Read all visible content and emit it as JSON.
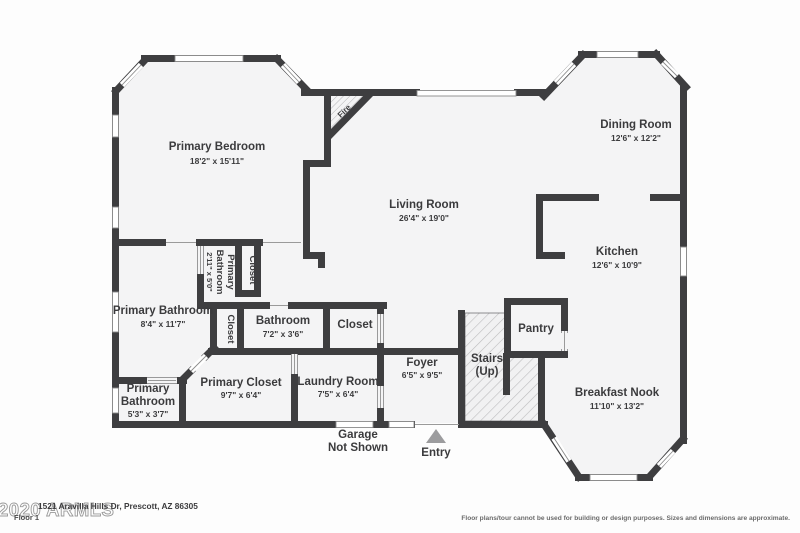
{
  "floorplan": {
    "rooms": [
      {
        "id": "primary-bedroom",
        "name": "Primary Bedroom",
        "dims": "18'2\" x 15'11\""
      },
      {
        "id": "dining-room",
        "name": "Dining Room",
        "dims": "12'6\" x 12'2\""
      },
      {
        "id": "living-room",
        "name": "Living Room",
        "dims": "26'4\" x 19'0\""
      },
      {
        "id": "kitchen",
        "name": "Kitchen",
        "dims": "12'6\" x 10'9\""
      },
      {
        "id": "primary-bathroom",
        "name": "Primary Bathroom",
        "dims": "8'4\" x 11'7\""
      },
      {
        "id": "primary-bathroom-small",
        "name_line1": "Primary",
        "name_line2": "Bathroom",
        "dims": "2'11\" x 5'0\"",
        "orientation": "vertical"
      },
      {
        "id": "closet-upper",
        "name": "Closet",
        "orientation": "vertical"
      },
      {
        "id": "closet-lower",
        "name": "Closet",
        "orientation": "vertical"
      },
      {
        "id": "bathroom",
        "name": "Bathroom",
        "dims": "7'2\" x 3'6\""
      },
      {
        "id": "closet-hall",
        "name": "Closet"
      },
      {
        "id": "primary-bathroom-2",
        "name_line1": "Primary",
        "name_line2": "Bathroom",
        "dims": "5'3\" x 3'7\""
      },
      {
        "id": "primary-closet",
        "name": "Primary Closet",
        "dims": "9'7\" x 6'4\""
      },
      {
        "id": "laundry-room",
        "name": "Laundry Room",
        "dims": "7'5\" x 6'4\""
      },
      {
        "id": "foyer",
        "name": "Foyer",
        "dims": "6'5\" x 9'5\""
      },
      {
        "id": "stairs",
        "name_line1": "Stairs",
        "name_line2": "(Up)"
      },
      {
        "id": "pantry",
        "name": "Pantry"
      },
      {
        "id": "breakfast-nook",
        "name": "Breakfast Nook",
        "dims": "11'10\" x 13'2\""
      }
    ],
    "annotations": {
      "fireplace": "Fire",
      "entry": "Entry",
      "garage_line1": "Garage",
      "garage_line2": "Not Shown"
    },
    "footer": {
      "address": "1521 Aravilla Hills Dr, Prescott, AZ 86305",
      "floor": "Floor 1",
      "disclaimer": "Floor plans/tour cannot be used for building or design purposes. Sizes and dimensions are approximate.",
      "watermark": "2020 ARMLS"
    },
    "colors": {
      "wall": "#3e3e40",
      "floor": "#f4f4f5",
      "text": "#3b3b3d",
      "window_line": "#8a8a8a"
    }
  }
}
